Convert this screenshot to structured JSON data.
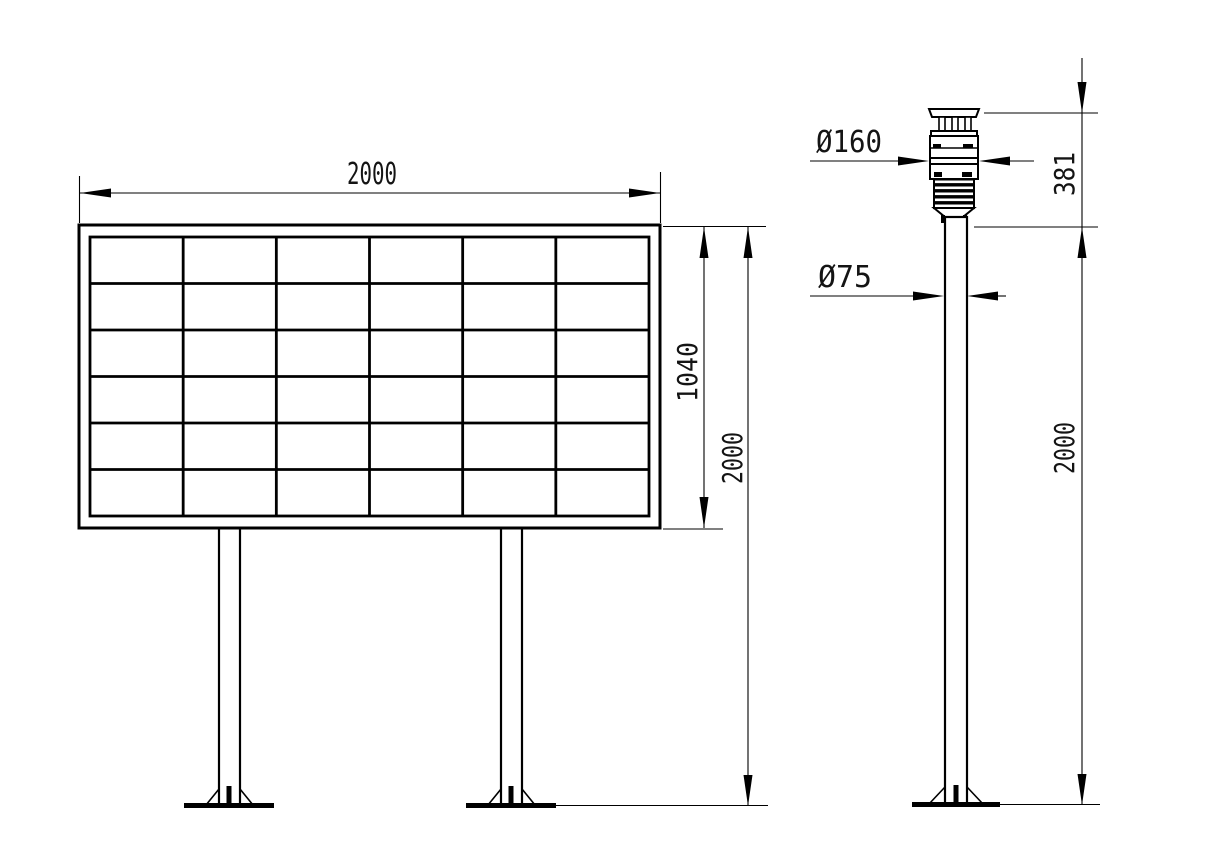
{
  "colors": {
    "background": "#ffffff",
    "line": "#000000",
    "text": "#141414"
  },
  "front_view": {
    "width_dim": "2000",
    "screen_height_dim": "1040",
    "mount_height_dim": "2000",
    "grid": {
      "rows": 6,
      "cols": 6
    }
  },
  "side_view": {
    "sensor_diameter_dim": "Ø160",
    "sensor_height_dim": "381",
    "pole_diameter_dim": "Ø75",
    "pole_height_dim": "2000"
  }
}
